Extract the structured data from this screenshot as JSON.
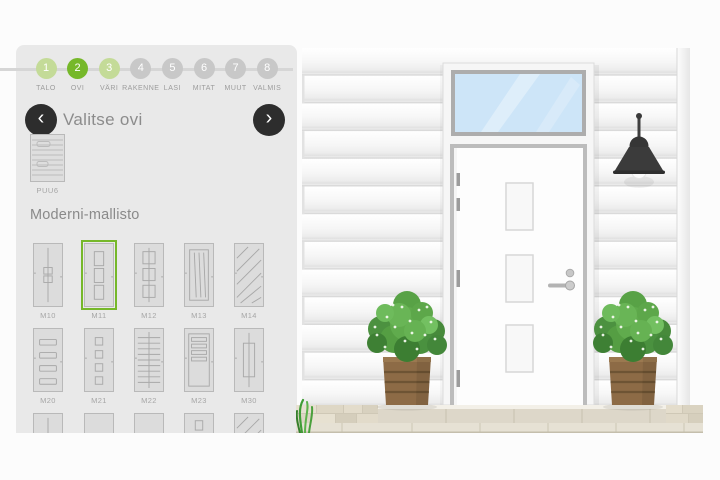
{
  "stepper": {
    "steps": [
      {
        "num": "1",
        "label": "TALO",
        "state": "visited"
      },
      {
        "num": "2",
        "label": "OVI",
        "state": "active"
      },
      {
        "num": "3",
        "label": "VÄRI",
        "state": "visited"
      },
      {
        "num": "4",
        "label": "RAKENNE",
        "state": "upcoming"
      },
      {
        "num": "5",
        "label": "LASI",
        "state": "upcoming"
      },
      {
        "num": "6",
        "label": "MITAT",
        "state": "upcoming"
      },
      {
        "num": "7",
        "label": "MUUT",
        "state": "upcoming"
      },
      {
        "num": "8",
        "label": "VALMIS",
        "state": "upcoming"
      }
    ]
  },
  "door_picker": {
    "title": "Valitse ovi",
    "current_model": "PUU6",
    "section_title": "Moderni-mallisto",
    "selected_model": "M11",
    "models": [
      {
        "id": "M10",
        "style": "center-line"
      },
      {
        "id": "M11",
        "style": "panels-3"
      },
      {
        "id": "M12",
        "style": "squares-3"
      },
      {
        "id": "M13",
        "style": "grooves"
      },
      {
        "id": "M14",
        "style": "diagonal"
      },
      {
        "id": "M20",
        "style": "bars-4"
      },
      {
        "id": "M21",
        "style": "squares-4"
      },
      {
        "id": "M22",
        "style": "slats-dense"
      },
      {
        "id": "M23",
        "style": "slats-top"
      },
      {
        "id": "M30",
        "style": "tall-frame"
      },
      {
        "id": "",
        "style": "center-line"
      },
      {
        "id": "",
        "style": "plain"
      },
      {
        "id": "",
        "style": "plain"
      },
      {
        "id": "",
        "style": "square-top"
      },
      {
        "id": "",
        "style": "diagonal"
      }
    ]
  },
  "icons": {
    "chevron_left": "‹",
    "chevron_right": "›"
  },
  "colors": {
    "accent_green": "#76b82a",
    "step_visited_green": "#c4db98",
    "step_upcoming_gray": "#c8c8c8",
    "panel_background": "#e9e9e9",
    "page_background": "#fcfcfc",
    "glass_blue": "#cde5f8"
  }
}
